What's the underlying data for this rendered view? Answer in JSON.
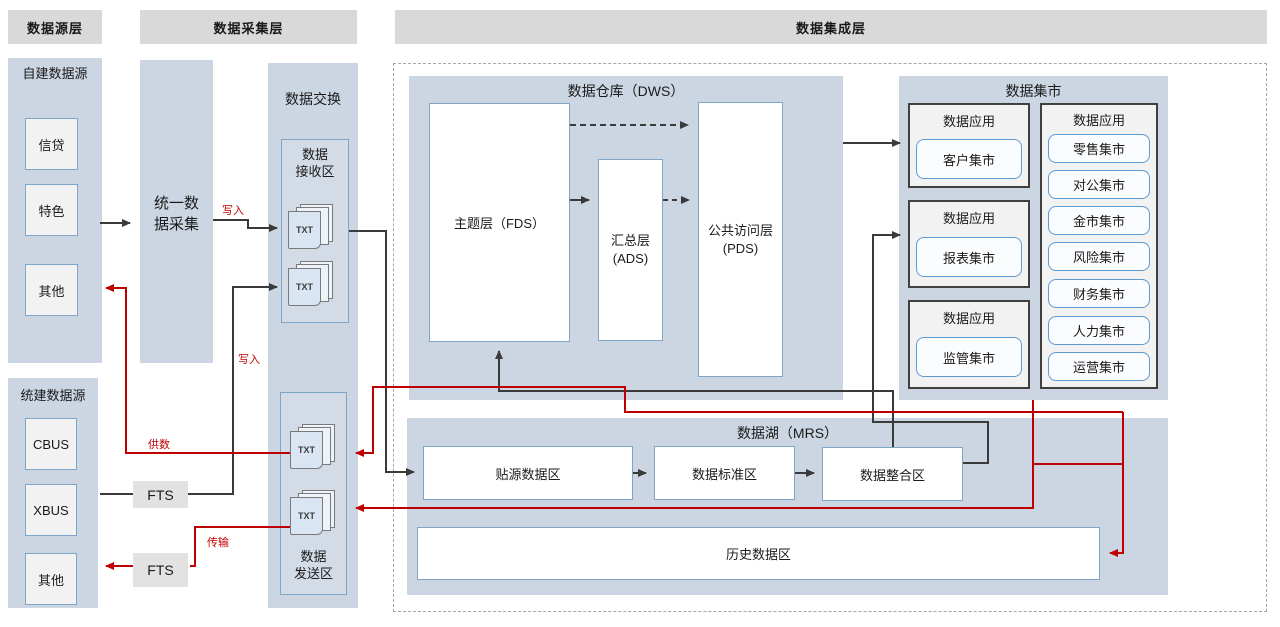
{
  "headers": {
    "source_layer": "数据源层",
    "collect_layer": "数据采集层",
    "integration_layer": "数据集成层"
  },
  "source_layer": {
    "self_built": {
      "title": "自建数据源",
      "items": [
        "信贷",
        "特色",
        "其他"
      ]
    },
    "unified": {
      "title": "统建数据源",
      "items": [
        "CBUS",
        "XBUS",
        "其他"
      ]
    }
  },
  "collect_layer": {
    "unified_collect": "统一数\n据采集",
    "fts_upper": "FTS",
    "fts_lower": "FTS"
  },
  "exchange": {
    "title": "数据交换",
    "receive_zone": "数据\n接收区",
    "send_zone": "数据\n发送区",
    "txt": "TXT"
  },
  "dws": {
    "title": "数据仓库（DWS）",
    "fds": "主题层（FDS）",
    "ads": "汇总层\n(ADS)",
    "pds": "公共访问层\n(PDS)"
  },
  "mart": {
    "title": "数据集市",
    "app_groups": [
      {
        "title": "数据应用",
        "item": "客户集市"
      },
      {
        "title": "数据应用",
        "item": "报表集市"
      },
      {
        "title": "数据应用",
        "item": "监管集市"
      }
    ],
    "right_group": {
      "title": "数据应用",
      "items": [
        "零售集市",
        "对公集市",
        "金市集市",
        "风险集市",
        "财务集市",
        "人力集市",
        "运营集市"
      ]
    }
  },
  "lake": {
    "title": "数据湖（MRS）",
    "zones": [
      "贴源数据区",
      "数据标准区",
      "数据整合区"
    ],
    "history": "历史数据区"
  },
  "edge_labels": {
    "write_top": "写入",
    "write_mid": "写入",
    "supply": "供数",
    "transfer": "传输"
  },
  "colors": {
    "flow_red": "#c00000",
    "flow_black": "#3a3a3a",
    "panel_blue": "#ccd5e2",
    "header_gray": "#d9d9d9",
    "box_border_blue": "#7ea6c8"
  }
}
